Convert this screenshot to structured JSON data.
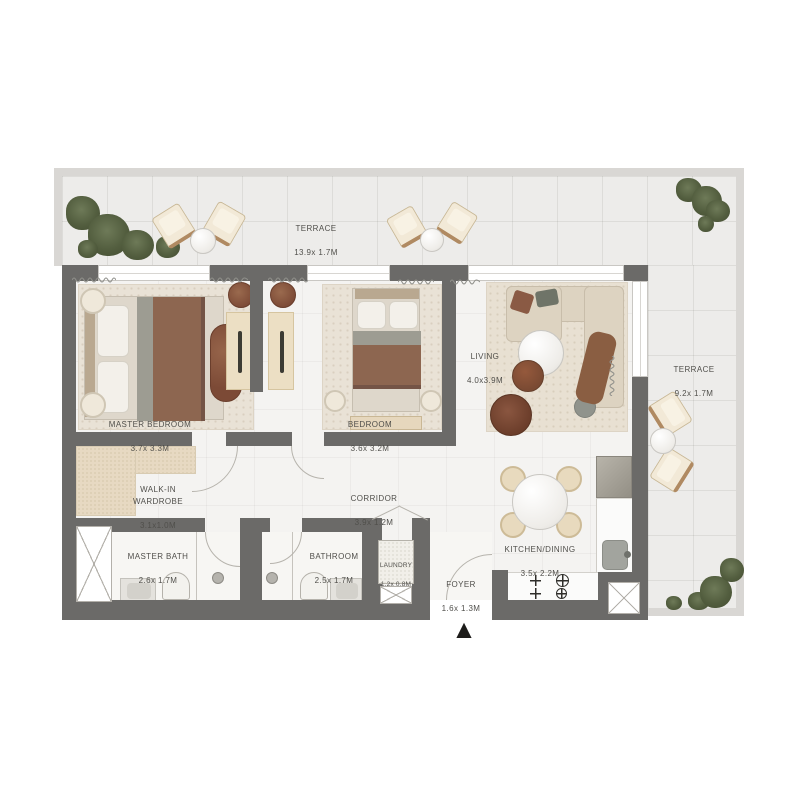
{
  "palette": {
    "wall": "#6b6a68",
    "interior_floor": "#f4f3f1",
    "terrace_floor": "#edecea",
    "terrace_edge": "#d9d7d4",
    "rug_beige": "#e9e2d6",
    "wood_beige": "#ecdfc4",
    "accent_brown": "#8d6650",
    "plant_green": "#535e3f",
    "marble_white": "#f7f6f3",
    "label_text": "#504f4b",
    "entry_arrow": "#1d1c1a"
  },
  "icons": {
    "entry_arrow": "▲"
  },
  "rooms": {
    "terrace_top": {
      "label": "TERRACE",
      "dims": "13.9x 1.7M"
    },
    "master_bedroom": {
      "label": "MASTER BEDROOM",
      "dims": "3.7x 3.3M"
    },
    "bedroom": {
      "label": "BEDROOM",
      "dims": "3.6x 3.2M"
    },
    "living": {
      "label": "LIVING",
      "dims": "4.0x3.9M"
    },
    "terrace_right": {
      "label": "TERRACE",
      "dims": "9.2x 1.7M"
    },
    "walk_in_wardrobe": {
      "label": "WALK-IN\nWARDROBE",
      "dims": "3.1x1.0M"
    },
    "corridor": {
      "label": "CORRIDOR",
      "dims": "3.9x 1.2M"
    },
    "master_bath": {
      "label": "MASTER BATH",
      "dims": "2.6x 1.7M"
    },
    "bathroom": {
      "label": "BATHROOM",
      "dims": "2.5x 1.7M"
    },
    "laundry": {
      "label": "LAUNDRY",
      "dims": "1.2x 0.8M"
    },
    "foyer": {
      "label": "FOYER",
      "dims": "1.6x 1.3M"
    },
    "kitchen_dining": {
      "label": "KITCHEN/DINING",
      "dims": "3.5x 2.2M"
    }
  }
}
